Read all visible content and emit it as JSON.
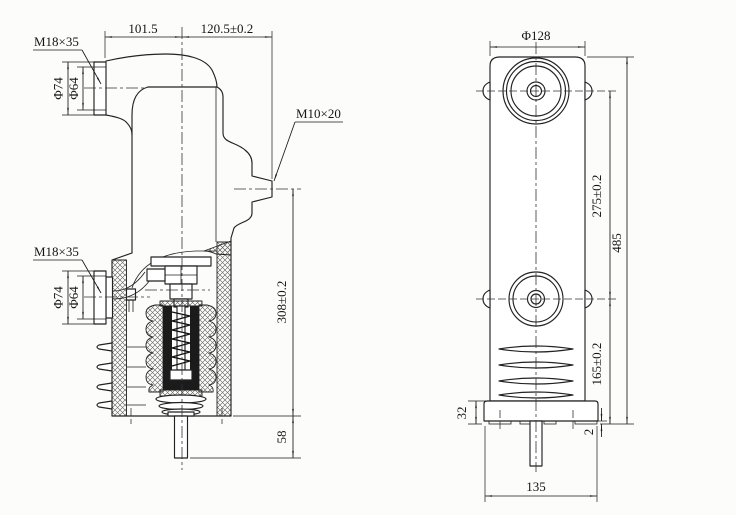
{
  "drawing": {
    "title": "vacuum interrupter embedded pole - dimension drawing",
    "colors": {
      "background": "#fcfcfa",
      "line": "#222222",
      "hatch": "#555555",
      "dark_fill": "#1b1b1b"
    },
    "left_view": {
      "labels": {
        "thread_top": "M18×35",
        "thread_bottom": "M18×35",
        "thread_side": "M10×20"
      },
      "dimensions": {
        "width_left": "101.5",
        "width_right": "120.5±0.2",
        "dia_outer_top": "Φ74",
        "dia_inner_top": "Φ64",
        "dia_outer_bottom": "Φ74",
        "dia_inner_bottom": "Φ64",
        "height_body": "308±0.2",
        "stem_length": "58"
      }
    },
    "right_view": {
      "dimensions": {
        "dia_cap": "Φ128",
        "terminal_spacing": "275±0.2",
        "lower_terminal_height": "165±0.2",
        "total_height": "485",
        "flange_height": "32",
        "pad_thickness": "2",
        "base_width": "135"
      }
    }
  }
}
